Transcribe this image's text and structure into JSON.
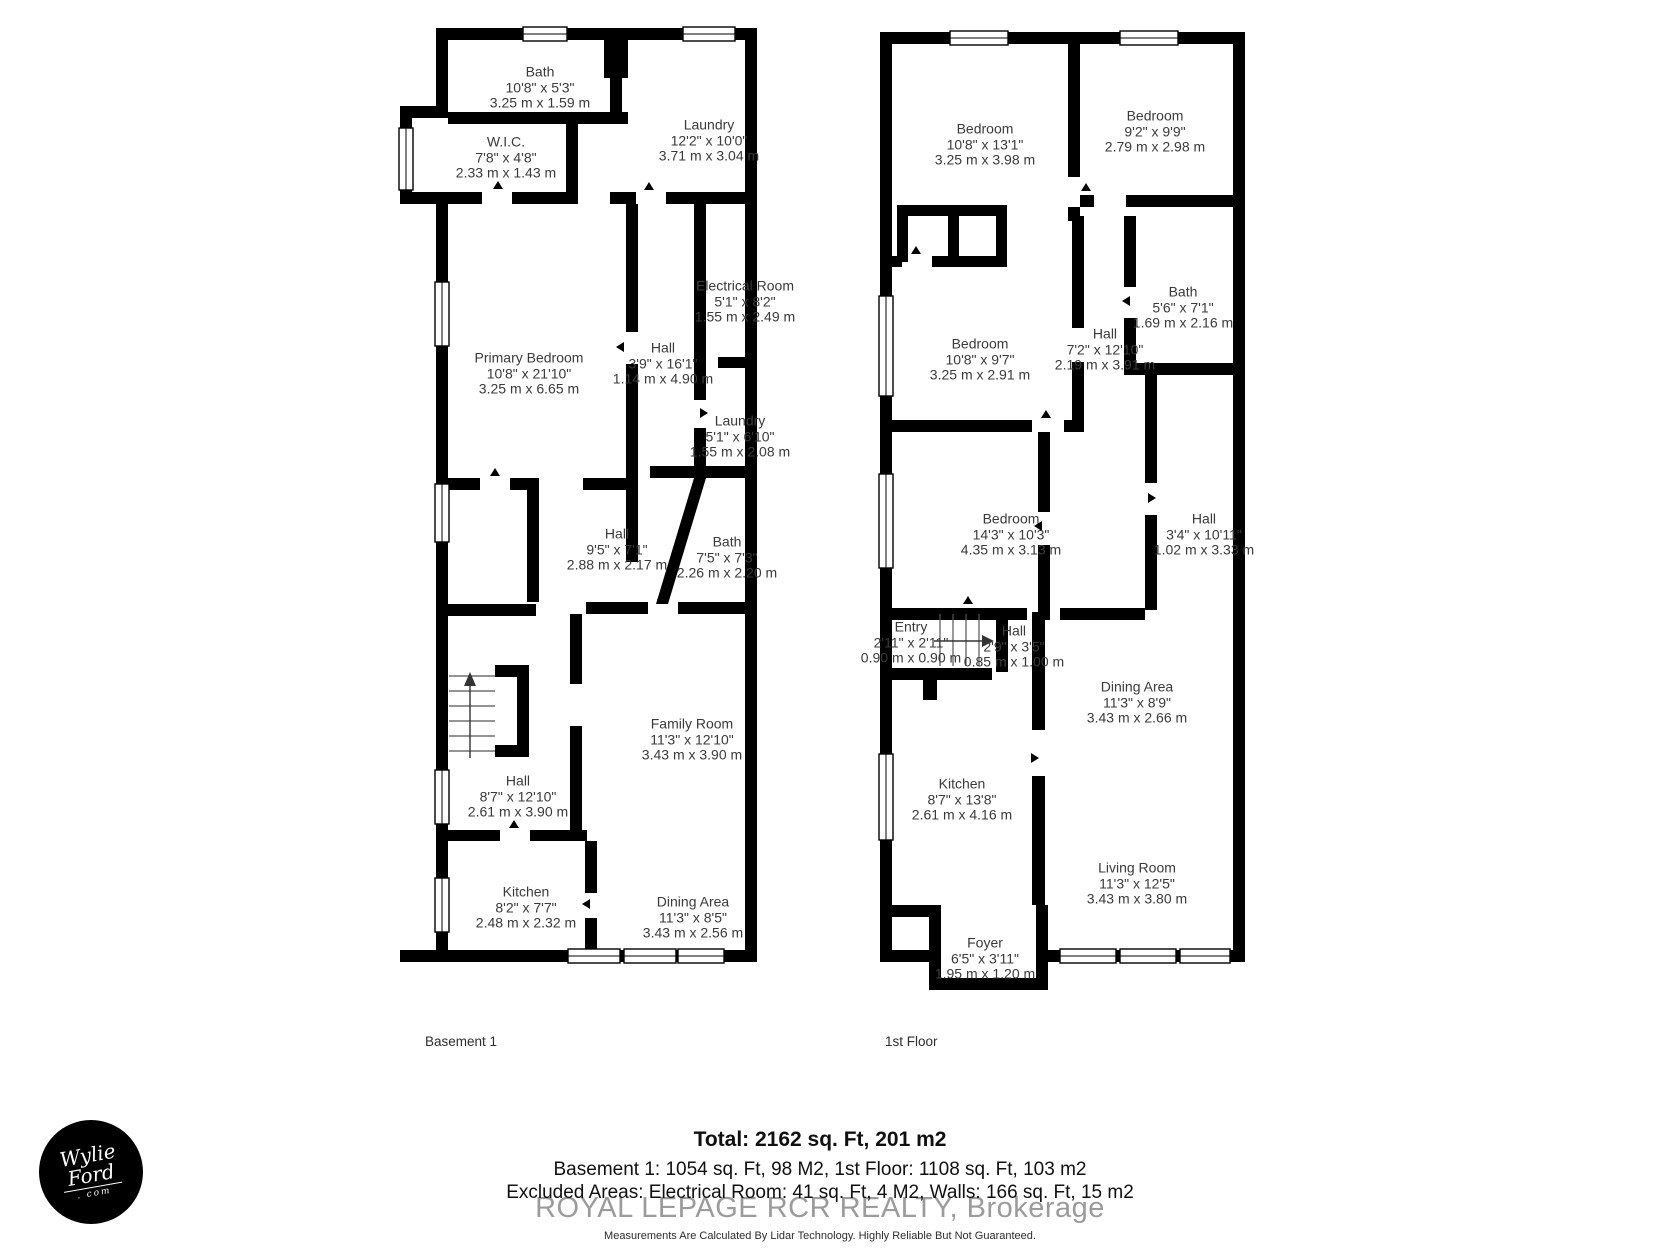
{
  "floors": [
    {
      "label": "Basement 1",
      "rooms": [
        {
          "name": "Bath",
          "imperial": "10'8\" x 5'3\"",
          "metric": "3.25 m x 1.59 m"
        },
        {
          "name": "W.I.C.",
          "imperial": "7'8\" x 4'8\"",
          "metric": "2.33 m x 1.43 m"
        },
        {
          "name": "Laundry",
          "imperial": "12'2\" x 10'0\"",
          "metric": "3.71 m x 3.04 m"
        },
        {
          "name": "Electrical Room",
          "imperial": "5'1\" x 8'2\"",
          "metric": "1.55 m x 2.49 m"
        },
        {
          "name": "Primary Bedroom",
          "imperial": "10'8\" x 21'10\"",
          "metric": "3.25 m x 6.65 m"
        },
        {
          "name": "Hall",
          "imperial": "3'9\" x 16'1\"",
          "metric": "1.14 m x 4.90 m"
        },
        {
          "name": "Laundry",
          "imperial": "5'1\" x 6'10\"",
          "metric": "1.55 m x 2.08 m"
        },
        {
          "name": "Hall",
          "imperial": "9'5\" x 7'1\"",
          "metric": "2.88 m x 2.17 m"
        },
        {
          "name": "Bath",
          "imperial": "7'5\" x 7'3\"",
          "metric": "2.26 m x 2.20 m"
        },
        {
          "name": "Family Room",
          "imperial": "11'3\" x 12'10\"",
          "metric": "3.43 m x 3.90 m"
        },
        {
          "name": "Hall",
          "imperial": "8'7\" x 12'10\"",
          "metric": "2.61 m x 3.90 m"
        },
        {
          "name": "Kitchen",
          "imperial": "8'2\" x 7'7\"",
          "metric": "2.48 m x 2.32 m"
        },
        {
          "name": "Dining Area",
          "imperial": "11'3\" x 8'5\"",
          "metric": "3.43 m x 2.56 m"
        }
      ]
    },
    {
      "label": "1st Floor",
      "rooms": [
        {
          "name": "Bedroom",
          "imperial": "10'8\" x 13'1\"",
          "metric": "3.25 m x 3.98 m"
        },
        {
          "name": "Bedroom",
          "imperial": "9'2\" x 9'9\"",
          "metric": "2.79 m x 2.98 m"
        },
        {
          "name": "Bedroom",
          "imperial": "10'8\" x 9'7\"",
          "metric": "3.25 m x 2.91 m"
        },
        {
          "name": "Hall",
          "imperial": "7'2\" x 12'10\"",
          "metric": "2.19 m x 3.91 m"
        },
        {
          "name": "Bath",
          "imperial": "5'6\" x 7'1\"",
          "metric": "1.69 m x 2.16 m"
        },
        {
          "name": "Bedroom",
          "imperial": "14'3\" x 10'3\"",
          "metric": "4.35 m x 3.13 m"
        },
        {
          "name": "Hall",
          "imperial": "3'4\" x 10'11\"",
          "metric": "1.02 m x 3.33 m"
        },
        {
          "name": "Entry",
          "imperial": "2'11\" x 2'11\"",
          "metric": "0.90 m x 0.90 m"
        },
        {
          "name": "Hall",
          "imperial": "2'9\" x 3'5\"",
          "metric": "0.85 m x 1.00 m"
        },
        {
          "name": "Dining Area",
          "imperial": "11'3\" x 8'9\"",
          "metric": "3.43 m x 2.66 m"
        },
        {
          "name": "Kitchen",
          "imperial": "8'7\" x 13'8\"",
          "metric": "2.61 m x 4.16 m"
        },
        {
          "name": "Living Room",
          "imperial": "11'3\" x 12'5\"",
          "metric": "3.43 m x 3.80 m"
        },
        {
          "name": "Foyer",
          "imperial": "6'5\" x 3'11\"",
          "metric": "1.95 m x 1.20 m"
        }
      ]
    }
  ],
  "summary": {
    "total": "Total: 2162 sq. Ft, 201 m2",
    "floors_line": "Basement 1: 1054 sq. Ft, 98 M2, 1st Floor: 1108 sq. Ft, 103 m2",
    "excluded_line": "Excluded Areas: Electrical Room: 41 sq. Ft, 4 M2, Walls: 166 sq. Ft, 15 m2",
    "watermark": "ROYAL LEPAGE RCR REALTY, Brokerage",
    "disclaimer": "Measurements Are Calculated By Lidar Technology. Highly Reliable But Not Guaranteed."
  },
  "logo": {
    "line1": "Wylie",
    "line2": "Ford",
    "line3": ". com"
  },
  "colors": {
    "wall": "#000000",
    "label_text": "#3a3a3a",
    "watermark": "#9b9b9b"
  }
}
